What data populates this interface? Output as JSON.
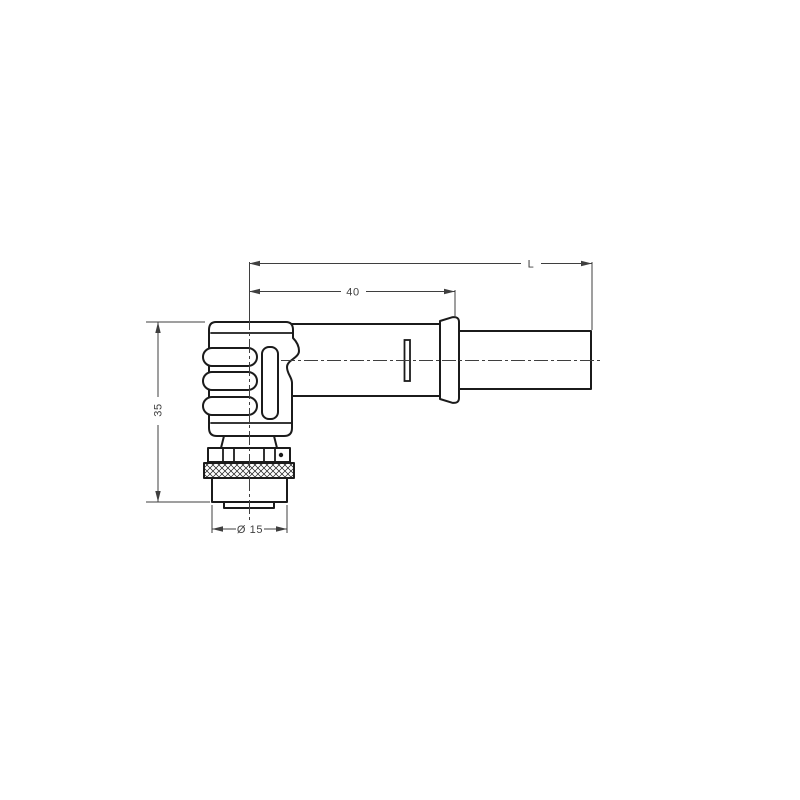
{
  "page": {
    "background": "#ffffff"
  },
  "drawing": {
    "outline_color": "#1b1b1b",
    "dimension_color": "#3f3f3f",
    "labels": {
      "total_length": "L",
      "front_length": "40",
      "height": "35",
      "diameter": "Ø 15"
    }
  }
}
